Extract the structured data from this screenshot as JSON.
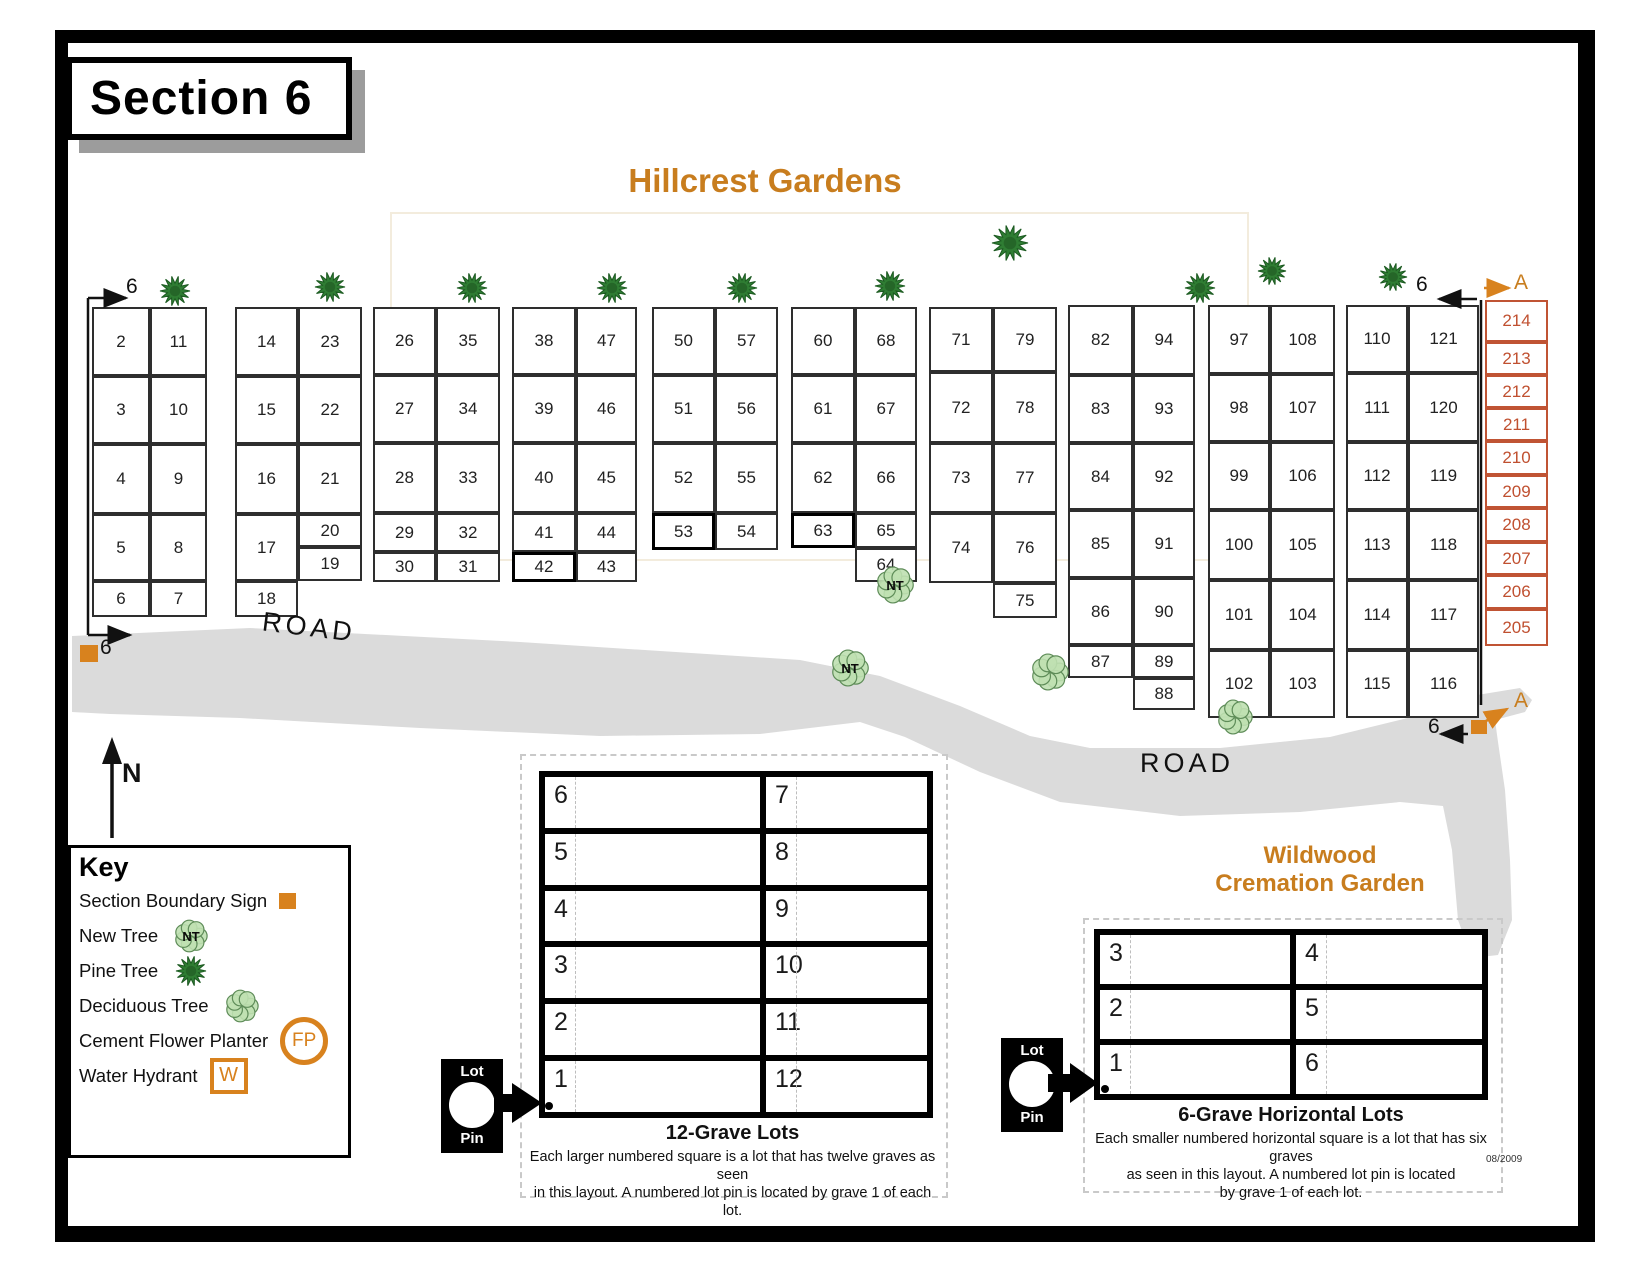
{
  "section_title": "Section 6",
  "garden_title": "Hillcrest Gardens",
  "wildwood": {
    "line1": "Wildwood",
    "line2": "Cremation Garden"
  },
  "date_stamp": "08/2009",
  "pin": {
    "top": "Lot",
    "bottom": "Pin"
  },
  "key": {
    "heading": "Key",
    "items": [
      {
        "label": "Section Boundary Sign",
        "icon": "boundary-sign"
      },
      {
        "label": "New Tree",
        "icon": "new-tree",
        "icon_text": "NT"
      },
      {
        "label": "Pine Tree",
        "icon": "pine-tree"
      },
      {
        "label": "Deciduous Tree",
        "icon": "deciduous-tree"
      },
      {
        "label": "Cement Flower Planter",
        "icon": "flower-planter",
        "icon_text": "FP"
      },
      {
        "label": "Water Hydrant",
        "icon": "water-hydrant",
        "icon_text": "W"
      }
    ]
  },
  "twelve_grave": {
    "title": "12-Grave Lots",
    "desc1": "Each larger numbered square is a lot that has twelve graves as seen",
    "desc2": "in this layout.  A numbered lot pin is located by grave 1 of each lot.",
    "left_numbers": [
      "6",
      "5",
      "4",
      "3",
      "2",
      "1"
    ],
    "right_numbers": [
      "7",
      "8",
      "9",
      "10",
      "11",
      "12"
    ]
  },
  "six_grave": {
    "title": "6-Grave Horizontal Lots",
    "desc1": "Each smaller numbered horizontal square is a lot that has six graves",
    "desc2": "as seen in this layout.  A numbered lot pin is located",
    "desc3": "by grave 1 of each lot.",
    "left_numbers": [
      "3",
      "2",
      "1"
    ],
    "right_numbers": [
      "4",
      "5",
      "6"
    ]
  },
  "map": {
    "road_color": "#dbdbdb",
    "accent_orange": "#D8821E",
    "a_column_red": "#c05434",
    "blocks": [
      {
        "name": "block-1",
        "cells": [
          [
            "2",
            92,
            307,
            58,
            69
          ],
          [
            "11",
            150,
            307,
            57,
            69
          ],
          [
            "3",
            92,
            376,
            58,
            68
          ],
          [
            "10",
            150,
            376,
            57,
            68
          ],
          [
            "4",
            92,
            444,
            58,
            70
          ],
          [
            "9",
            150,
            444,
            57,
            70
          ],
          [
            "5",
            92,
            514,
            58,
            67
          ],
          [
            "8",
            150,
            514,
            57,
            67
          ],
          [
            "6",
            92,
            581,
            58,
            36
          ],
          [
            "7",
            150,
            581,
            57,
            36
          ]
        ]
      },
      {
        "name": "block-2",
        "cells": [
          [
            "14",
            235,
            307,
            63,
            69
          ],
          [
            "23",
            298,
            307,
            64,
            69
          ],
          [
            "15",
            235,
            376,
            63,
            68
          ],
          [
            "22",
            298,
            376,
            64,
            68
          ],
          [
            "16",
            235,
            444,
            63,
            70
          ],
          [
            "21",
            298,
            444,
            64,
            70
          ],
          [
            "17",
            235,
            514,
            63,
            67
          ],
          [
            "20",
            298,
            514,
            64,
            33
          ],
          [
            "19",
            298,
            547,
            64,
            34
          ],
          [
            "18",
            235,
            581,
            63,
            36
          ]
        ]
      },
      {
        "name": "block-3",
        "cells": [
          [
            "26",
            373,
            307,
            63,
            68
          ],
          [
            "35",
            436,
            307,
            64,
            68
          ],
          [
            "27",
            373,
            375,
            63,
            68
          ],
          [
            "34",
            436,
            375,
            64,
            68
          ],
          [
            "28",
            373,
            443,
            63,
            70
          ],
          [
            "33",
            436,
            443,
            64,
            70
          ],
          [
            "29",
            373,
            513,
            63,
            39
          ],
          [
            "32",
            436,
            513,
            64,
            39
          ],
          [
            "30",
            373,
            552,
            63,
            30
          ],
          [
            "31",
            436,
            552,
            64,
            30
          ]
        ]
      },
      {
        "name": "block-4",
        "cells": [
          [
            "38",
            512,
            307,
            64,
            68
          ],
          [
            "47",
            576,
            307,
            61,
            68
          ],
          [
            "39",
            512,
            375,
            64,
            68
          ],
          [
            "46",
            576,
            375,
            61,
            68
          ],
          [
            "40",
            512,
            443,
            64,
            70
          ],
          [
            "45",
            576,
            443,
            61,
            70
          ],
          [
            "41",
            512,
            513,
            64,
            39
          ],
          [
            "44",
            576,
            513,
            61,
            39
          ],
          [
            "42",
            512,
            552,
            64,
            30,
            1
          ],
          [
            "43",
            576,
            552,
            61,
            30
          ]
        ]
      },
      {
        "name": "block-5",
        "cells": [
          [
            "50",
            652,
            307,
            63,
            68
          ],
          [
            "57",
            715,
            307,
            63,
            68
          ],
          [
            "51",
            652,
            375,
            63,
            68
          ],
          [
            "56",
            715,
            375,
            63,
            68
          ],
          [
            "52",
            652,
            443,
            63,
            70
          ],
          [
            "55",
            715,
            443,
            63,
            70
          ],
          [
            "53",
            652,
            513,
            63,
            37,
            1
          ],
          [
            "54",
            715,
            513,
            63,
            37
          ]
        ]
      },
      {
        "name": "block-6",
        "cells": [
          [
            "60",
            791,
            307,
            64,
            68
          ],
          [
            "68",
            855,
            307,
            62,
            68
          ],
          [
            "61",
            791,
            375,
            64,
            68
          ],
          [
            "67",
            855,
            375,
            62,
            68
          ],
          [
            "62",
            791,
            443,
            64,
            70
          ],
          [
            "66",
            855,
            443,
            62,
            70
          ],
          [
            "63",
            791,
            513,
            64,
            35,
            1
          ],
          [
            "65",
            855,
            513,
            62,
            35
          ],
          [
            "64",
            855,
            548,
            62,
            34
          ]
        ]
      },
      {
        "name": "block-7",
        "cells": [
          [
            "71",
            929,
            307,
            64,
            65
          ],
          [
            "79",
            993,
            307,
            64,
            65
          ],
          [
            "72",
            929,
            372,
            64,
            71
          ],
          [
            "78",
            993,
            372,
            64,
            71
          ],
          [
            "73",
            929,
            443,
            64,
            70
          ],
          [
            "77",
            993,
            443,
            64,
            70
          ],
          [
            "74",
            929,
            513,
            64,
            70
          ],
          [
            "76",
            993,
            513,
            64,
            70
          ],
          [
            "75",
            993,
            583,
            64,
            35
          ]
        ]
      },
      {
        "name": "block-8",
        "cells": [
          [
            "82",
            1068,
            305,
            65,
            70
          ],
          [
            "94",
            1133,
            305,
            62,
            70
          ],
          [
            "83",
            1068,
            375,
            65,
            68
          ],
          [
            "93",
            1133,
            375,
            62,
            68
          ],
          [
            "84",
            1068,
            443,
            65,
            67
          ],
          [
            "92",
            1133,
            443,
            62,
            67
          ],
          [
            "85",
            1068,
            510,
            65,
            68
          ],
          [
            "91",
            1133,
            510,
            62,
            68
          ],
          [
            "86",
            1068,
            578,
            65,
            67
          ],
          [
            "90",
            1133,
            578,
            62,
            67
          ],
          [
            "87",
            1068,
            645,
            65,
            33
          ],
          [
            "89",
            1133,
            645,
            62,
            33
          ],
          [
            "88",
            1133,
            678,
            62,
            32
          ]
        ]
      },
      {
        "name": "block-9",
        "cells": [
          [
            "97",
            1208,
            305,
            62,
            69
          ],
          [
            "108",
            1270,
            305,
            65,
            69
          ],
          [
            "98",
            1208,
            374,
            62,
            68
          ],
          [
            "107",
            1270,
            374,
            65,
            68
          ],
          [
            "99",
            1208,
            442,
            62,
            68
          ],
          [
            "106",
            1270,
            442,
            65,
            68
          ],
          [
            "100",
            1208,
            510,
            62,
            70
          ],
          [
            "105",
            1270,
            510,
            65,
            70
          ],
          [
            "101",
            1208,
            580,
            62,
            70
          ],
          [
            "104",
            1270,
            580,
            65,
            70
          ],
          [
            "102",
            1208,
            650,
            62,
            68
          ],
          [
            "103",
            1270,
            650,
            65,
            68
          ]
        ]
      },
      {
        "name": "block-10",
        "cells": [
          [
            "110",
            1346,
            305,
            62,
            68
          ],
          [
            "121",
            1408,
            305,
            71,
            68
          ],
          [
            "111",
            1346,
            373,
            62,
            69
          ],
          [
            "120",
            1408,
            373,
            71,
            69
          ],
          [
            "112",
            1346,
            442,
            62,
            68
          ],
          [
            "119",
            1408,
            442,
            71,
            68
          ],
          [
            "113",
            1346,
            510,
            62,
            70
          ],
          [
            "118",
            1408,
            510,
            71,
            70
          ],
          [
            "114",
            1346,
            580,
            62,
            70
          ],
          [
            "117",
            1408,
            580,
            71,
            70
          ],
          [
            "115",
            1346,
            650,
            62,
            68
          ],
          [
            "116",
            1408,
            650,
            71,
            68
          ]
        ]
      }
    ],
    "a_column": {
      "x": 1485,
      "w": 63,
      "cells": [
        [
          "214",
          300,
          42
        ],
        [
          "213",
          342,
          33
        ],
        [
          "212",
          375,
          33
        ],
        [
          "211",
          408,
          33
        ],
        [
          "210",
          441,
          34
        ],
        [
          "209",
          475,
          33
        ],
        [
          "208",
          508,
          34
        ],
        [
          "207",
          542,
          33
        ],
        [
          "206",
          575,
          34
        ],
        [
          "205",
          609,
          37
        ]
      ]
    },
    "trees": [
      {
        "type": "pine",
        "x": 175,
        "y": 291,
        "r": 15
      },
      {
        "type": "pine",
        "x": 330,
        "y": 287,
        "r": 15
      },
      {
        "type": "pine",
        "x": 472,
        "y": 288,
        "r": 15
      },
      {
        "type": "pine",
        "x": 612,
        "y": 288,
        "r": 15
      },
      {
        "type": "pine",
        "x": 742,
        "y": 288,
        "r": 15
      },
      {
        "type": "pine",
        "x": 890,
        "y": 286,
        "r": 15
      },
      {
        "type": "pine",
        "x": 1010,
        "y": 243,
        "r": 18
      },
      {
        "type": "pine",
        "x": 1200,
        "y": 288,
        "r": 15
      },
      {
        "type": "pine",
        "x": 1272,
        "y": 271,
        "r": 14
      },
      {
        "type": "pine",
        "x": 1393,
        "y": 277,
        "r": 14
      },
      {
        "type": "new",
        "x": 895,
        "y": 585,
        "r": 17,
        "label": "NT"
      },
      {
        "type": "new",
        "x": 850,
        "y": 668,
        "r": 17,
        "label": "NT"
      },
      {
        "type": "deciduous",
        "x": 1050,
        "y": 672,
        "r": 17
      },
      {
        "type": "deciduous",
        "x": 1235,
        "y": 717,
        "r": 16
      }
    ],
    "labels": [
      {
        "t": "6",
        "x": 126,
        "y": 276,
        "s": 21
      },
      {
        "t": "6",
        "x": 100,
        "y": 637,
        "s": 21
      },
      {
        "t": "6",
        "x": 1416,
        "y": 274,
        "s": 21
      },
      {
        "t": "A",
        "x": 1514,
        "y": 272,
        "s": 21,
        "c": "#C87D1E"
      },
      {
        "t": "6",
        "x": 1428,
        "y": 716,
        "s": 21
      },
      {
        "t": "A",
        "x": 1514,
        "y": 690,
        "s": 21,
        "c": "#C87D1E"
      },
      {
        "t": "N",
        "x": 122,
        "y": 760,
        "s": 27,
        "b": 1
      },
      {
        "t": "ROAD",
        "x": 262,
        "y": 614,
        "s": 27,
        "r": 7,
        "ls": 4
      },
      {
        "t": "ROAD",
        "x": 1140,
        "y": 750,
        "s": 27,
        "ls": 4
      }
    ],
    "boundary_signs": [
      {
        "x": 80,
        "y": 645,
        "w": 18,
        "h": 17
      },
      {
        "x": 1471,
        "y": 720,
        "w": 16,
        "h": 14
      }
    ]
  }
}
